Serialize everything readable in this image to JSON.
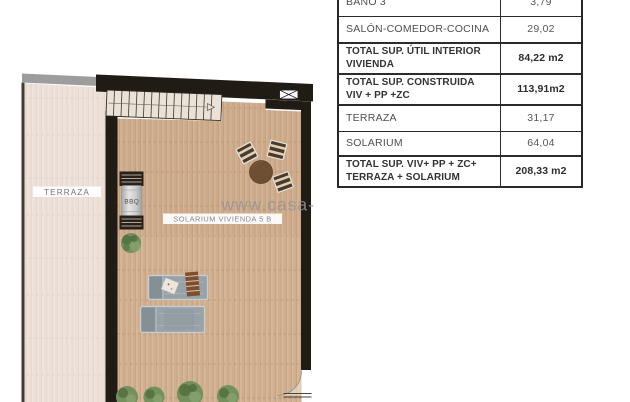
{
  "plan": {
    "labels": {
      "terraza": "TERRAZA",
      "solarium": "SOLARIUM VIVIENDA 5 B",
      "bbq": "BBQ",
      "watermark": "www.casa-"
    },
    "colors": {
      "terraza_floor": "#ecdfd8",
      "terraza_plank_line": "#dcc9bf",
      "solarium_floor": "#cfae8e",
      "solarium_plank_line": "#b3906e",
      "wall": "#211b16",
      "gray_band": "#9d9d9d",
      "left_wall_line": "#453b33",
      "stairs": "#eae2d6",
      "rooflight": "#ffffff",
      "lounger": "#98a2a9",
      "lounger_edge": "#c9ced2",
      "towel": "#7d4f30",
      "cushion": "#ece7dd",
      "plant": "#6e8a55",
      "plant_dark": "#55703f",
      "chair": "#4d3a2a",
      "chair_stripe": "#ded2bd",
      "table_wood": "#6f4f33",
      "bbq_counter": "#29201a",
      "bbq_cylinder": "#c9c9c9",
      "label_text": "#757575",
      "watermark_text": "#969696"
    }
  },
  "table": {
    "rows": [
      {
        "label": "BAÑO 3",
        "value": "3,79"
      },
      {
        "label": "SALÓN-COMEDOR-COCINA",
        "value": "29,02"
      },
      {
        "label": "TOTAL SUP. ÚTIL INTERIOR\nVIVIENDA",
        "value": "84,22 m2"
      },
      {
        "label": "TOTAL SUP. CONSTRUIDA\nVIV + PP +ZC",
        "value": "113,91m2"
      },
      {
        "label": "TERRAZA",
        "value": "31,17"
      },
      {
        "label": "SOLARIUM",
        "value": "64,04"
      },
      {
        "label": "TOTAL SUP. VIV+ PP + ZC+\nTERRAZA + SOLARIUM",
        "value": "208,33 m2"
      }
    ]
  }
}
